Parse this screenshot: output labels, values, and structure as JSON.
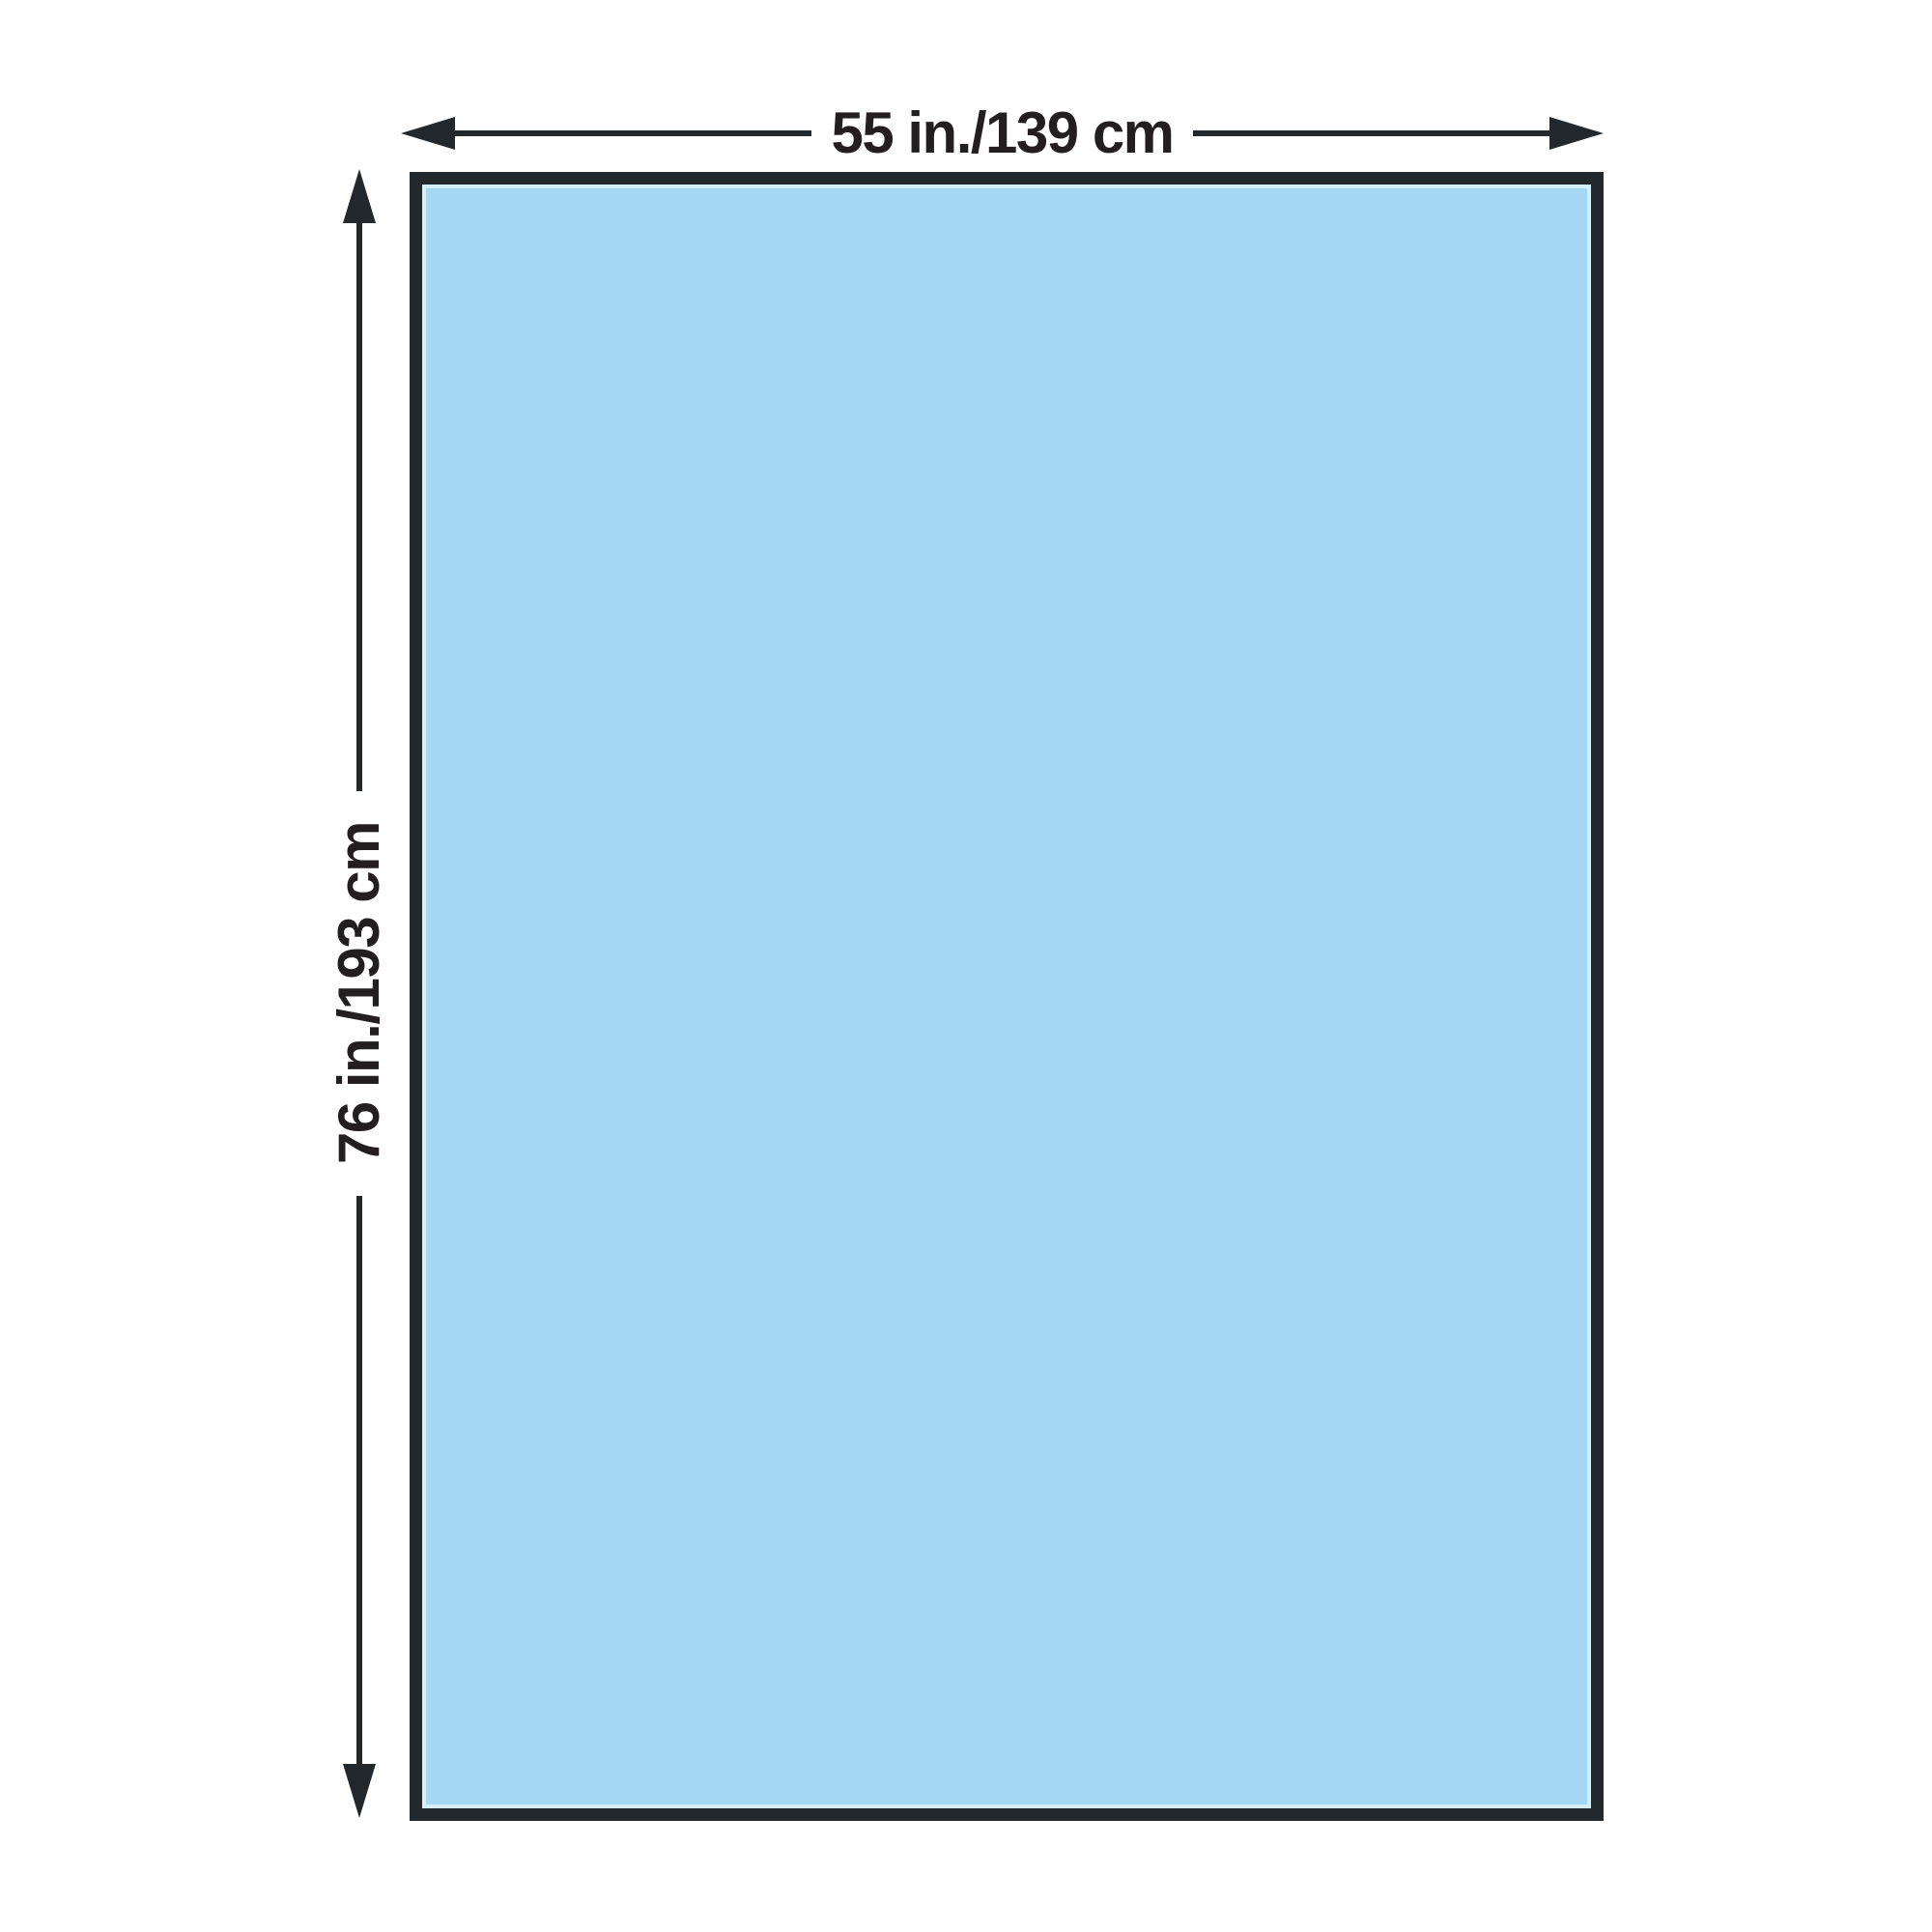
{
  "diagram": {
    "width_label": "55 in./139 cm",
    "height_label": "76 in./193 cm"
  },
  "colors": {
    "drape_fill": "#a4d7f4",
    "outline": "#23282d",
    "ink": "#231f20",
    "background": "#ffffff"
  }
}
